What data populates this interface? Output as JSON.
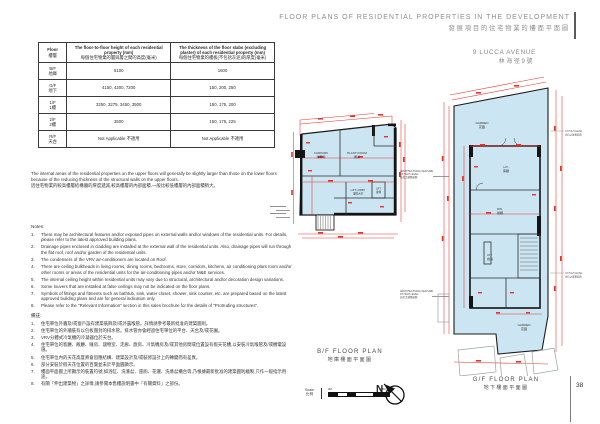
{
  "header": {
    "title_en": "FLOOR PLANS OF RESIDENTIAL PROPERTIES IN THE DEVELOPMENT",
    "title_zh": "發展項目的住宅物業的樓面平面圖",
    "property_en": "9 LUCCA AVENUE",
    "property_zh": "林海徑9號"
  },
  "table": {
    "col_floor_en": "Floor",
    "col_floor_zh": "樓層",
    "col_height_en": "The floor-to-floor height of each residential property (mm)",
    "col_height_zh": "每個住宅物業的層與層之間的高度(毫米)",
    "col_thickness_en": "The thickness of the floor slabs (excluding plaster) of each residential property (mm)",
    "col_thickness_zh": "每個住宅物業的樓板(不包括灰泥)的厚度(毫米)",
    "rows": [
      {
        "floor_en": "B/F",
        "floor_zh": "地庫",
        "height": "5100",
        "thickness": "1600"
      },
      {
        "floor_en": "G/F",
        "floor_zh": "地下",
        "height": "4150, 4200, 7200",
        "thickness": "150, 200, 250"
      },
      {
        "floor_en": "1/F",
        "floor_zh": "1樓",
        "height": "3250, 3275, 3450, 3500",
        "thickness": "150, 175, 200"
      },
      {
        "floor_en": "2/F",
        "floor_zh": "2樓",
        "height": "3500",
        "thickness": "150, 175, 225"
      },
      {
        "floor_en": "R/F",
        "floor_zh": "天台",
        "height": "Not Applicable 不適用",
        "thickness": "Not Applicable 不適用"
      }
    ]
  },
  "intro": {
    "en": "The internal areas of the residential properties on the upper floors will generally be slightly larger than those on the lower floors because of the reducing thickness of the structural walls on the upper floors.",
    "zh": "因住宅物業的較高樓層結構牆的厚度遞減,較高樓層的內部面積,一般比較低樓層的內部面積稍大。"
  },
  "notes": {
    "label_en": "Notes:",
    "en": [
      "There may be architectural features and/or exposed pipes on external walls and/or windows of the residential units. For details, please refer to the latest approved building plans.",
      "Drainage pipes enclosed in cladding are installed at the external wall of the residential units. Also, drainage pipes will run through the flat roof, roof and/or garden of the residential units.",
      "The condensers of the VRV air-conditioners are located on Roof.",
      "There are ceiling bulkheads in living rooms, dining rooms, bedrooms, store, corridors, kitchens, air conditioning plant room and/or other rooms or areas of the residential units for the air-conditioning pipes and/or M&E services.",
      "The internal ceiling height within residential units may vary due to structural, architectural and/or decoration design variations.",
      "Some louvers that are installed at false ceilings may not be indicated on the floor plans.",
      "Symbols of fittings and fitments such as bathtub, sink, water closet, shower, sink counter, etc. are prepared based on the latest approved building plans and are for general indication only.",
      "Please refer to the \"Relevant Information\" section in this sales brochure for the details of \"Protruding structures\"."
    ],
    "label_zh": "備註:",
    "zh": [
      "住宅單位外牆及/或窗戶設有建築裝飾及/或外露喉管。詳情請參考最新批准的建築圖則。",
      "住宅單位的外牆裝有以包板圍封的排水管。排水管亦會經過住宅單位的平台、天台及/或花園。",
      "VRV分體式冷氣機的冷凝器位於天台。",
      "住宅單位的客廳、飯廳、睡房、儲物室、走廊、廚房、冷氣機房及/或其他房間或位置設有假天花槽,以安裝冷氣喉管及/或機電設施。",
      "住宅單位內的天花高度將會因應結構、建築設計及/或裝修設計上的轉變而有差異。",
      "部分安裝於假天花位置的百葉並未於平面圖顯示。",
      "樓面平面圖上所顯示的裝置符號,如浴缸、洗滌盆、座廁、花灑、洗滌盆櫃台等,乃根據最新批准的建築圖則繪製,只作一般指示用途。",
      "有關「伸出建築物」之詳情,請參閱本售樓說明書中「有關資料」之部份。"
    ]
  },
  "plans": {
    "bf": {
      "caption_en": "B/F FLOOR PLAN",
      "caption_zh": "地庫樓面平面圖",
      "rooms": {
        "room1_en": "CARPARK",
        "room1_zh": "停車場",
        "room2_en": "PLANT ROOM",
        "room2_zh": "機房",
        "lift_lobby_en": "LIFT LOBBY",
        "lift_lobby_zh": "電梯大堂",
        "lift_en": "LIFT",
        "lift_zh": "電梯"
      }
    },
    "gf": {
      "caption_en": "G/F FLOOR PLAN",
      "caption_zh": "地下樓面平面圖",
      "rooms": {
        "garden_en": "GARDEN",
        "garden_zh": "花園",
        "liv_en": "LIV.",
        "liv_zh": "客廳",
        "din_en": "DIN.",
        "din_zh": "飯廳",
        "kit_en": "KIT.",
        "kit_zh": "廚房",
        "garden2_en": "GARDEN",
        "garden2_zh": "花園"
      }
    }
  },
  "annotations": {
    "arch_line1": "ARCHITECTURAL FEATURE",
    "arch_line2": "AT HIGH LEVEL",
    "arch_zh": "高位之建築裝飾"
  },
  "scale": {
    "label_en": "Scale",
    "label_zh": "比例",
    "start": "0M",
    "end": "10M"
  },
  "north": "N",
  "page_number": "38"
}
